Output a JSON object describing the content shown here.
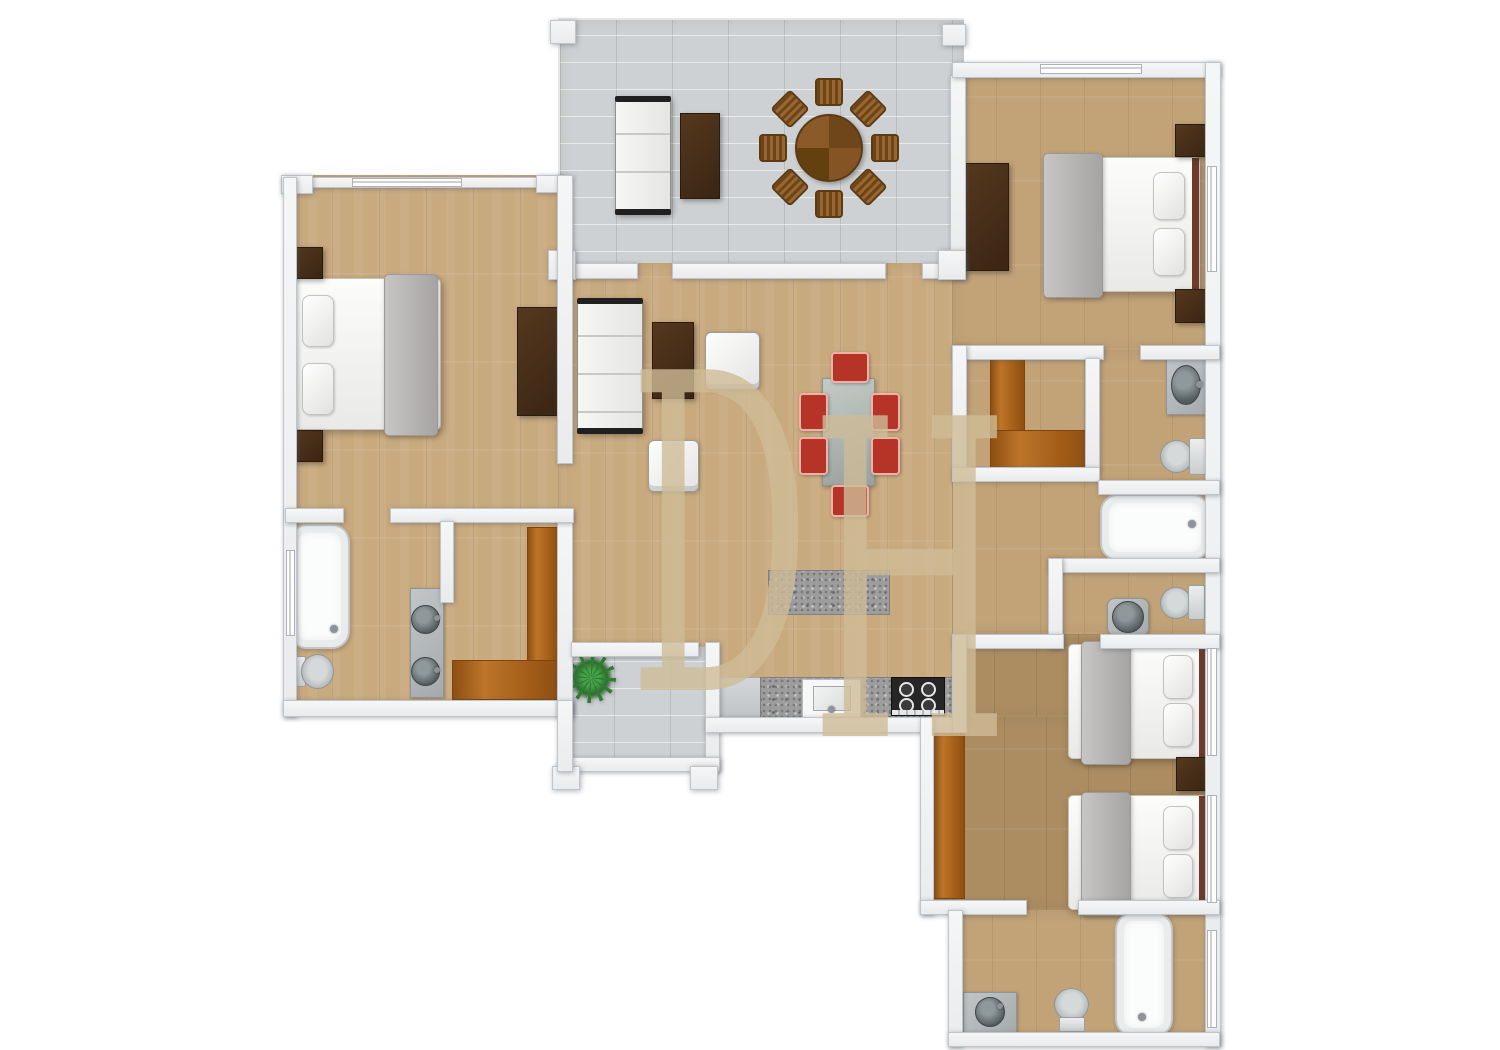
{
  "document": {
    "type": "floor-plan",
    "style": "3d-top-down-render",
    "visible_text": "DH"
  },
  "watermark": {
    "letters": [
      "D",
      "H"
    ],
    "color": "#cebc98"
  },
  "palette": {
    "background": "#ffffff",
    "wall": "#f2f3f5",
    "wall_border": "#c2c5c8",
    "wood_light": "#c9aa7f",
    "wood_mid": "#c2a378",
    "wood_dark": "#ac8d62",
    "closet_wood": "#a96018",
    "terrace_tile": "#ced1d3",
    "furniture_dark": "#46321f",
    "chair_red": "#b53327",
    "granite": "#9d9d9d",
    "fixture_gray": "#aeb4b6",
    "bed_white": "#f5f5f3",
    "blanket_gray": "#b5b4b2"
  },
  "rooms": [
    {
      "id": "terrace",
      "furniture": [
        "sofa",
        "coffee-table",
        "round-dining-table",
        "8-wicker-chairs"
      ]
    },
    {
      "id": "bedroom-left",
      "furniture": [
        "double-bed",
        "2-nightstands",
        "dresser"
      ]
    },
    {
      "id": "bathroom-left",
      "furniture": [
        "bathtub",
        "toilet",
        "double-vanity"
      ]
    },
    {
      "id": "closet-left",
      "furniture": [
        "l-shaped-wood-floor"
      ]
    },
    {
      "id": "living-room",
      "furniture": [
        "sofa",
        "coffee-table",
        "2-armchairs",
        "dining-table",
        "6-red-chairs"
      ]
    },
    {
      "id": "kitchen",
      "furniture": [
        "granite-island",
        "counter",
        "sink",
        "gas-stove"
      ]
    },
    {
      "id": "foyer",
      "furniture": [
        "plant"
      ]
    },
    {
      "id": "bedroom-top-right",
      "furniture": [
        "double-bed",
        "2-nightstands",
        "dresser"
      ]
    },
    {
      "id": "closet-right",
      "furniture": [
        "l-shaped-wood-floor"
      ]
    },
    {
      "id": "bathroom-right-upper",
      "furniture": [
        "wall-sink",
        "toilet",
        "bathtub"
      ]
    },
    {
      "id": "wc-right",
      "furniture": [
        "pedestal-sink",
        "toilet"
      ]
    },
    {
      "id": "bedroom-bottom-right",
      "furniture": [
        "2-double-beds",
        "nightstand",
        "closet-strip"
      ]
    },
    {
      "id": "bathroom-bottom-right",
      "furniture": [
        "vanity-sink",
        "toilet",
        "bathtub"
      ]
    }
  ]
}
